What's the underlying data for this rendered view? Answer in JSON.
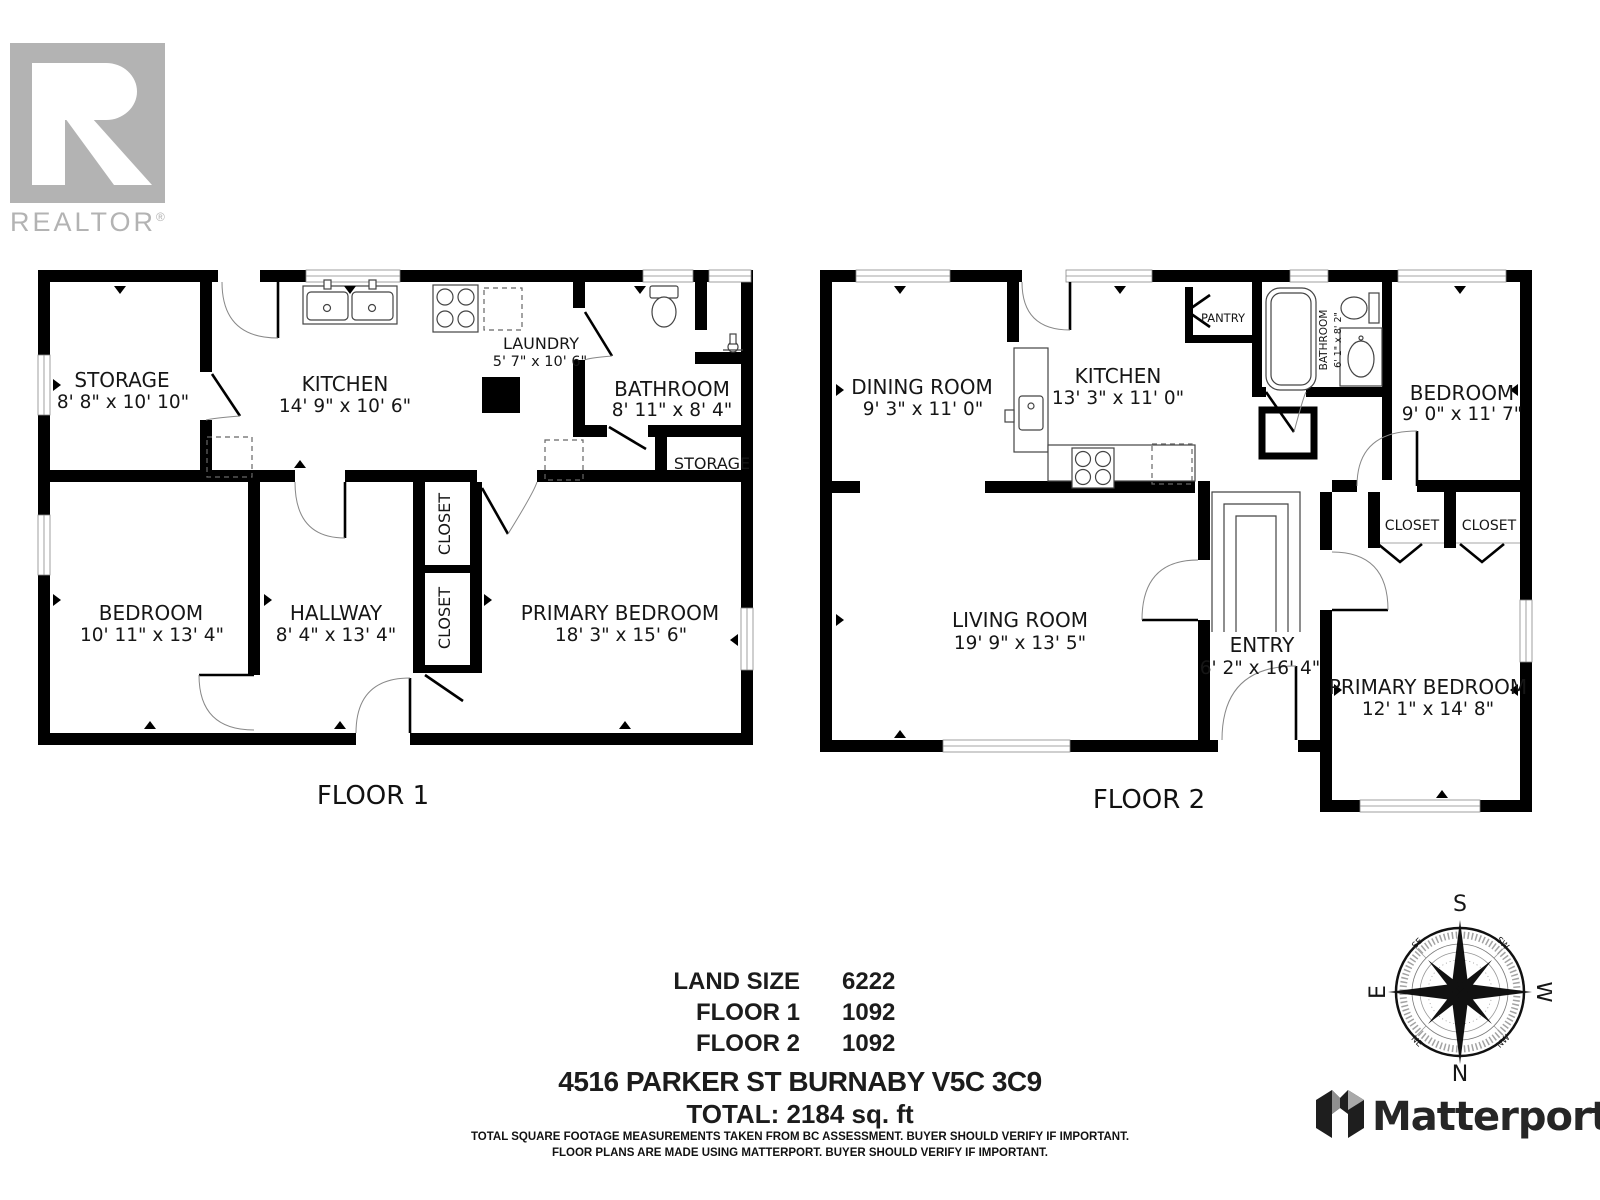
{
  "branding": {
    "realtor_logo_letter": "R",
    "realtor_text": "REALTOR",
    "registered_mark": "®",
    "matterport_name": "Matterport"
  },
  "floor1": {
    "label": "FLOOR 1",
    "rooms": {
      "storage": {
        "name": "STORAGE",
        "dims": "8' 8\" x 10' 10\""
      },
      "kitchen": {
        "name": "KITCHEN",
        "dims": "14' 9\" x 10' 6\""
      },
      "laundry": {
        "name": "LAUNDRY",
        "dims": "5' 7\" x 10' 6\""
      },
      "bathroom": {
        "name": "BATHROOM",
        "dims": "8' 11\" x 8' 4\""
      },
      "storage2": {
        "name": "STORAGE"
      },
      "bedroom": {
        "name": "BEDROOM",
        "dims": "10' 11\" x 13' 4\""
      },
      "hallway": {
        "name": "HALLWAY",
        "dims": "8' 4\" x 13' 4\""
      },
      "closet1": {
        "name": "CLOSET"
      },
      "closet2": {
        "name": "CLOSET"
      },
      "primary_bedroom": {
        "name": "PRIMARY BEDROOM",
        "dims": "18' 3\" x 15' 6\""
      }
    }
  },
  "floor2": {
    "label": "FLOOR 2",
    "rooms": {
      "dining_room": {
        "name": "DINING ROOM",
        "dims": "9' 3\" x 11' 0\""
      },
      "kitchen": {
        "name": "KITCHEN",
        "dims": "13' 3\" x 11' 0\""
      },
      "pantry": {
        "name": "PANTRY"
      },
      "bathroom": {
        "name": "BATHROOM",
        "dims": "6' 1\" x 8' 2\""
      },
      "bedroom": {
        "name": "BEDROOM",
        "dims": "9' 0\" x 11' 7\""
      },
      "living_room": {
        "name": "LIVING ROOM",
        "dims": "19' 9\" x 13' 5\""
      },
      "entry": {
        "name": "ENTRY",
        "dims": "6' 2\" x 16' 4\""
      },
      "closet1": {
        "name": "CLOSET"
      },
      "closet2": {
        "name": "CLOSET"
      },
      "primary_bedroom": {
        "name": "PRIMARY BEDROOM",
        "dims": "12' 1\" x 14' 8\""
      }
    }
  },
  "summary": {
    "rows": [
      {
        "label": "LAND SIZE",
        "value": "6222"
      },
      {
        "label": "FLOOR 1",
        "value": "1092"
      },
      {
        "label": "FLOOR 2",
        "value": "1092"
      }
    ],
    "address": "4516 PARKER ST BURNABY V5C 3C9",
    "total": "TOTAL: 2184 sq. ft",
    "disclaimer1": "TOTAL SQUARE FOOTAGE MEASUREMENTS TAKEN FROM BC ASSESSMENT. BUYER SHOULD VERIFY IF IMPORTANT.",
    "disclaimer2": "FLOOR PLANS ARE MADE USING MATTERPORT. BUYER SHOULD VERIFY IF IMPORTANT."
  },
  "compass": {
    "north": "N",
    "south": "S",
    "east": "E",
    "west": "W",
    "northeast": "NE",
    "northwest": "NW",
    "southeast": "SE",
    "southwest": "SW"
  },
  "colors": {
    "wall": "#000000",
    "fixture_line": "#444444",
    "text": "#161616",
    "realtor_gray": "#b3b3b3",
    "matterport_dark": "#262626"
  }
}
